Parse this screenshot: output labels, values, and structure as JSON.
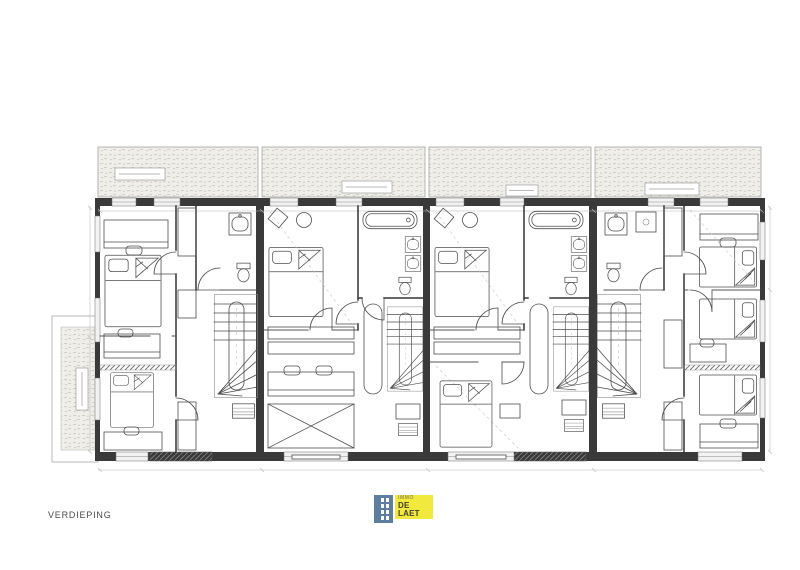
{
  "page": {
    "background": "#ffffff"
  },
  "plan": {
    "title": "VERDIEPING",
    "drawing_type": "architectural floor plan, 4 row-house units",
    "wall_color": "#3a3a3a",
    "line_color": "#4e4e4e",
    "roof_hatch_fill": "#efeee8"
  },
  "logo": {
    "top_text": "IMMO",
    "main_text": "DE LAET",
    "building_color": "#5e7da3",
    "box_color": "#f2e93d",
    "text_color": "#3f3f2e",
    "top_text_color": "#99914e"
  }
}
